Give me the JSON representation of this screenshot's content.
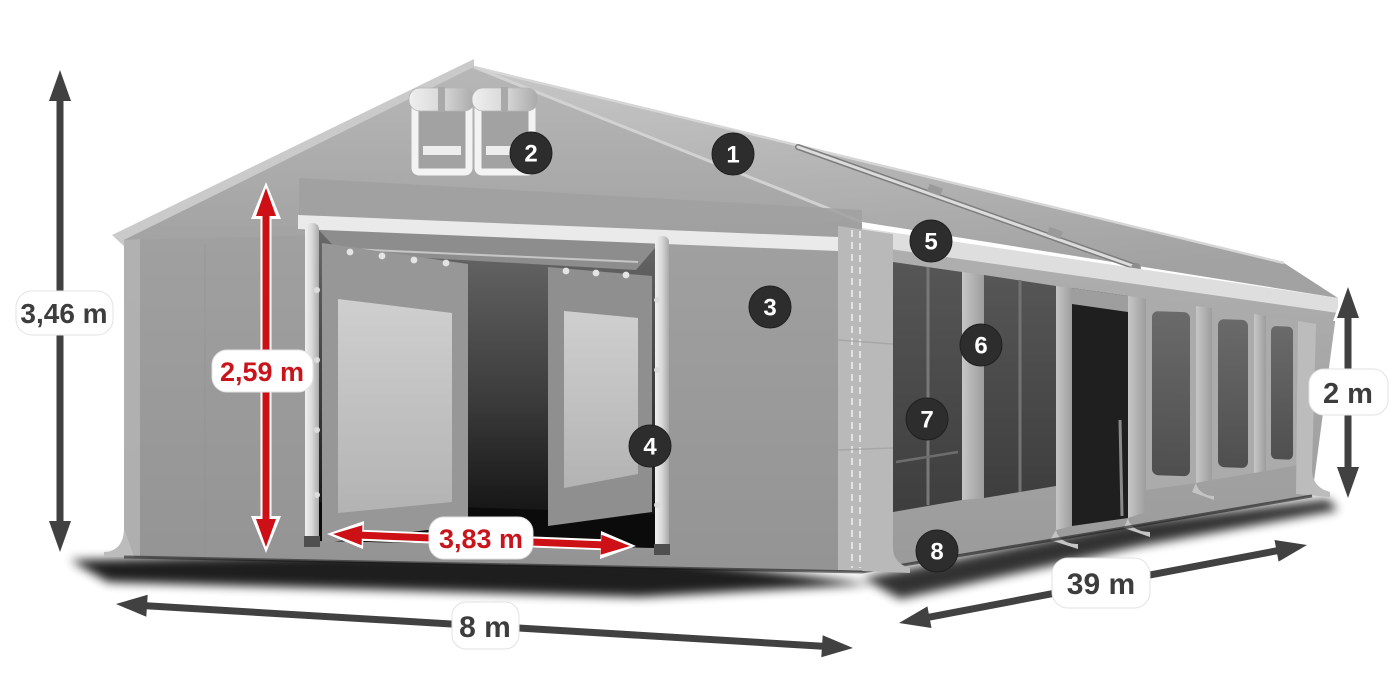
{
  "diagram": {
    "name": "party-tent-dimensions-diagram",
    "background": "#ffffff"
  },
  "labels": {
    "total_height": "3,46 m",
    "entrance_height": "2,59 m",
    "entrance_width": "3,83 m",
    "front_width": "8 m",
    "length": "39 m",
    "side_wall_height": "2 m"
  },
  "markers": [
    "1",
    "2",
    "3",
    "4",
    "5",
    "6",
    "7",
    "8"
  ],
  "colors": {
    "dimension_arrow_dark": "#414141",
    "dimension_arrow_red": "#cc1016",
    "label_text_dark": "#3d3d3d",
    "label_text_red": "#c8141b",
    "label_pill": "#ffffff",
    "marker_badge": "#2d2d2d",
    "marker_text": "#ffffff",
    "tent_fabric": "#a8a8a8"
  }
}
